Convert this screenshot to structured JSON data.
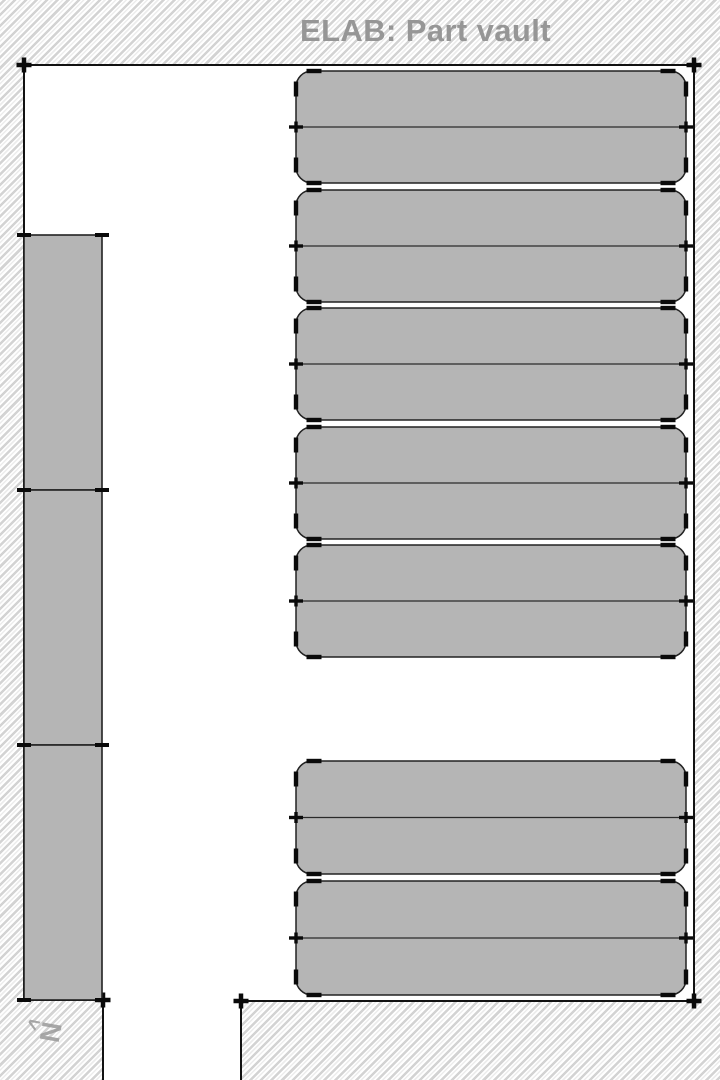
{
  "title": "ELAB: Part vault",
  "north_indicator": {
    "letter": "N",
    "arrow": "<"
  },
  "colors": {
    "hatch_stripe": "#d3d3d3",
    "hatch_stripe_light": "#ececec",
    "room_fill": "#ffffff",
    "wall_line": "#121212",
    "unit_fill": "#b5b5b5",
    "unit_border": "#222222",
    "divider_line": "#2a2a2a",
    "tick_mark": "#0a0a0a",
    "title_text": "#969696",
    "north_text": "#9a9a9a"
  },
  "plan": {
    "room_outline": [
      [
        24,
        65
      ],
      [
        694,
        65
      ],
      [
        694,
        1001
      ],
      [
        241,
        1001
      ],
      [
        241,
        1086
      ],
      [
        103,
        1086
      ],
      [
        103,
        1000
      ],
      [
        24,
        1000
      ]
    ],
    "room_corner_marks": [
      [
        24,
        65
      ],
      [
        694,
        65
      ],
      [
        694,
        1001
      ],
      [
        241,
        1001
      ],
      [
        103,
        1000
      ]
    ],
    "storage_boxes": {
      "x1": 24,
      "x2": 102,
      "rows": [
        [
          235,
          490
        ],
        [
          490,
          745
        ],
        [
          745,
          1000
        ]
      ]
    },
    "shelf_units": {
      "x1": 296,
      "x2": 686,
      "corner_radius": 16,
      "rows": [
        [
          71,
          183
        ],
        [
          190,
          302
        ],
        [
          308,
          420
        ],
        [
          427,
          539
        ],
        [
          545,
          657
        ],
        [
          761,
          874
        ],
        [
          881,
          995
        ]
      ]
    }
  }
}
